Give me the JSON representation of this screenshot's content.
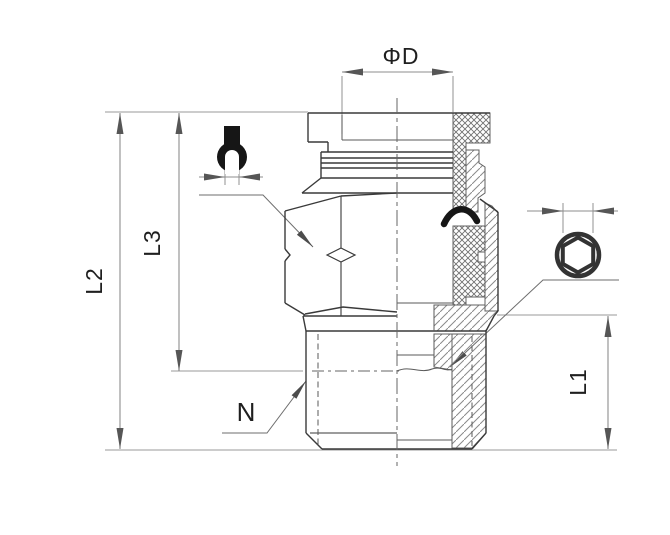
{
  "drawing": {
    "title": "push-to-connect-male-fitting-half-section",
    "labels": {
      "diameter": "ΦD",
      "length_overall": "L2",
      "length_body": "L3",
      "length_thread": "L1",
      "thread": "N"
    },
    "symbols": {
      "wrench": "open-end-wrench",
      "hex_socket": "hex-socket"
    },
    "colors": {
      "background": "#ffffff",
      "body_line": "#3a3a3a",
      "dimension_line": "#8e8e8e",
      "arrow": "#565656",
      "label_text": "#1f1f1f",
      "symbol_fill": "#161616",
      "hatch": "#8a8a8a"
    }
  }
}
